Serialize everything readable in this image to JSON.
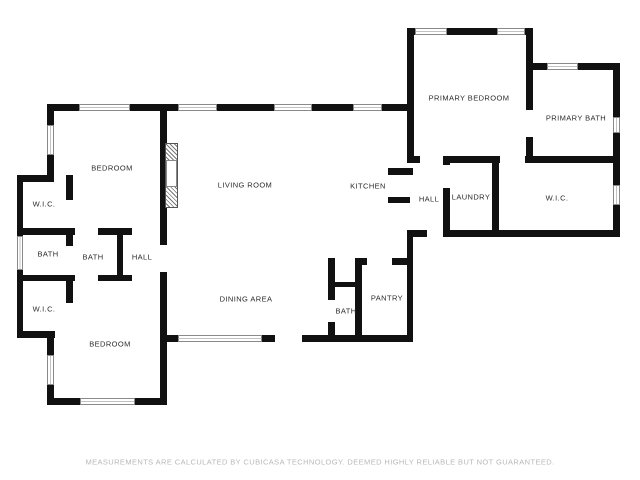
{
  "floor_plan": {
    "wall_color": "#111111",
    "background_color": "#ffffff",
    "rooms": [
      {
        "label": "BEDROOM"
      },
      {
        "label": "LIVING ROOM"
      },
      {
        "label": "KITCHEN"
      },
      {
        "label": "PRIMARY BEDROOM"
      },
      {
        "label": "PRIMARY BATH"
      },
      {
        "label": "HALL"
      },
      {
        "label": "LAUNDRY"
      },
      {
        "label": "W.I.C."
      },
      {
        "label": "W.I.C."
      },
      {
        "label": "BATH"
      },
      {
        "label": "BATH"
      },
      {
        "label": "HALL"
      },
      {
        "label": "W.I.C."
      },
      {
        "label": "BEDROOM"
      },
      {
        "label": "DINING AREA"
      },
      {
        "label": "BATH"
      },
      {
        "label": "PANTRY"
      }
    ],
    "features": [
      {
        "name": "fireplace"
      }
    ],
    "footer": {
      "disclaimer": "MEASUREMENTS ARE CALCULATED BY CUBICASA TECHNOLOGY. DEEMED HIGHLY RELIABLE BUT NOT GUARANTEED."
    }
  }
}
